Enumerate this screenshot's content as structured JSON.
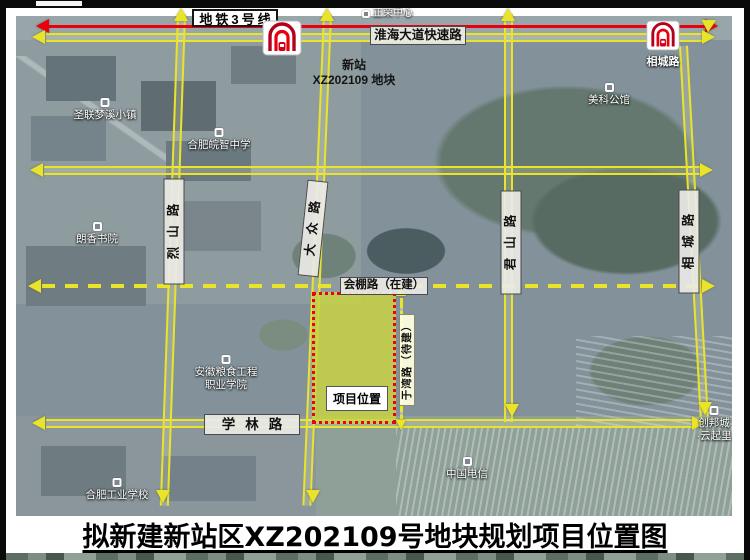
{
  "title": {
    "text": "拟新建新站区XZ202109号地块规划项目位置图"
  },
  "metro": {
    "line_label": "地铁3号线",
    "station_right": "相城路"
  },
  "roads": {
    "huaihai": "淮海大道快速路",
    "huipeng": "会棚路（在建）",
    "xuelin": "学林路",
    "lieshan": "烈山路",
    "dazhong": "大众路",
    "junshan": "君山路",
    "xiangcheng": "相城路",
    "yuwan": "于湾路（待建）"
  },
  "parcel": {
    "name_line1": "新站",
    "name_line2": "XZ202109 地块",
    "marker": "项目位置"
  },
  "pois": {
    "zhengrong": "正荣中心",
    "shenglian": "圣联梦溪小镇",
    "wanzhi": "合肥皖智中学",
    "langxiang": "朗香书院",
    "meike": "美科公馆",
    "liangshi1": "安徽粮食工程",
    "liangshi2": "职业学院",
    "gongye": "合肥工业学校",
    "dianxin": "中国电信",
    "chuangbang1": "创邦城",
    "chuangbang2": "·云起里"
  },
  "colors": {
    "road_yellow": "#e9e42a",
    "metro_red": "#e8000f",
    "parcel_fill": "#c9d53f",
    "parcel_border": "#e8001d"
  }
}
